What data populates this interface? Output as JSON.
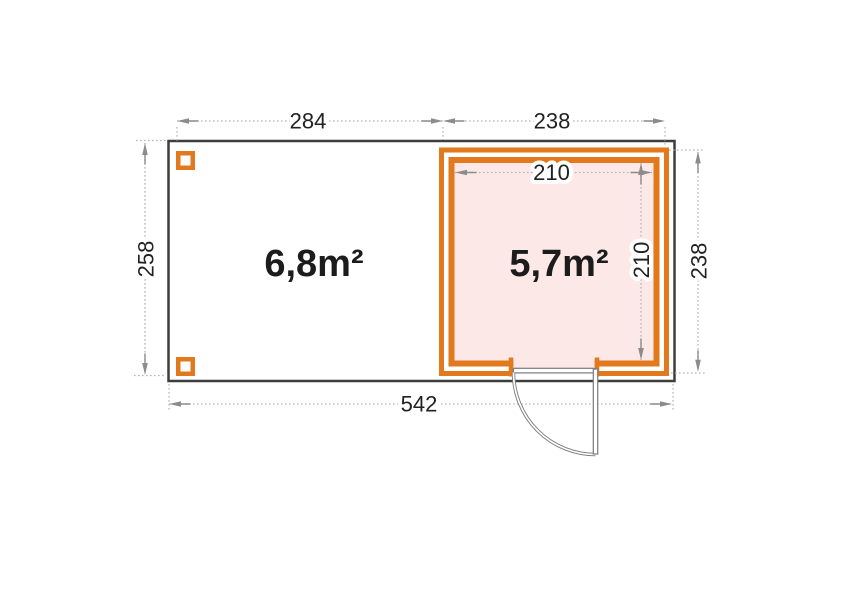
{
  "diagram": {
    "type": "floor-plan",
    "areas": {
      "left_room": "6,8m²",
      "right_room": "5,7m²"
    },
    "dimensions": {
      "top_left_width": "284",
      "top_right_width": "238",
      "left_height": "258",
      "right_height": "238",
      "inner_width": "210",
      "inner_height": "210",
      "total_width": "542"
    },
    "colors": {
      "wall_accent": "#E2791C",
      "room_fill": "#FCE9E7",
      "outline": "#3D3D3D",
      "dim_line": "#B5B5B5",
      "dim_arrow": "#8C8C8C",
      "dim_text": "#222222",
      "door": "#7A7A7A",
      "area_text": "#1C1C1C"
    }
  }
}
